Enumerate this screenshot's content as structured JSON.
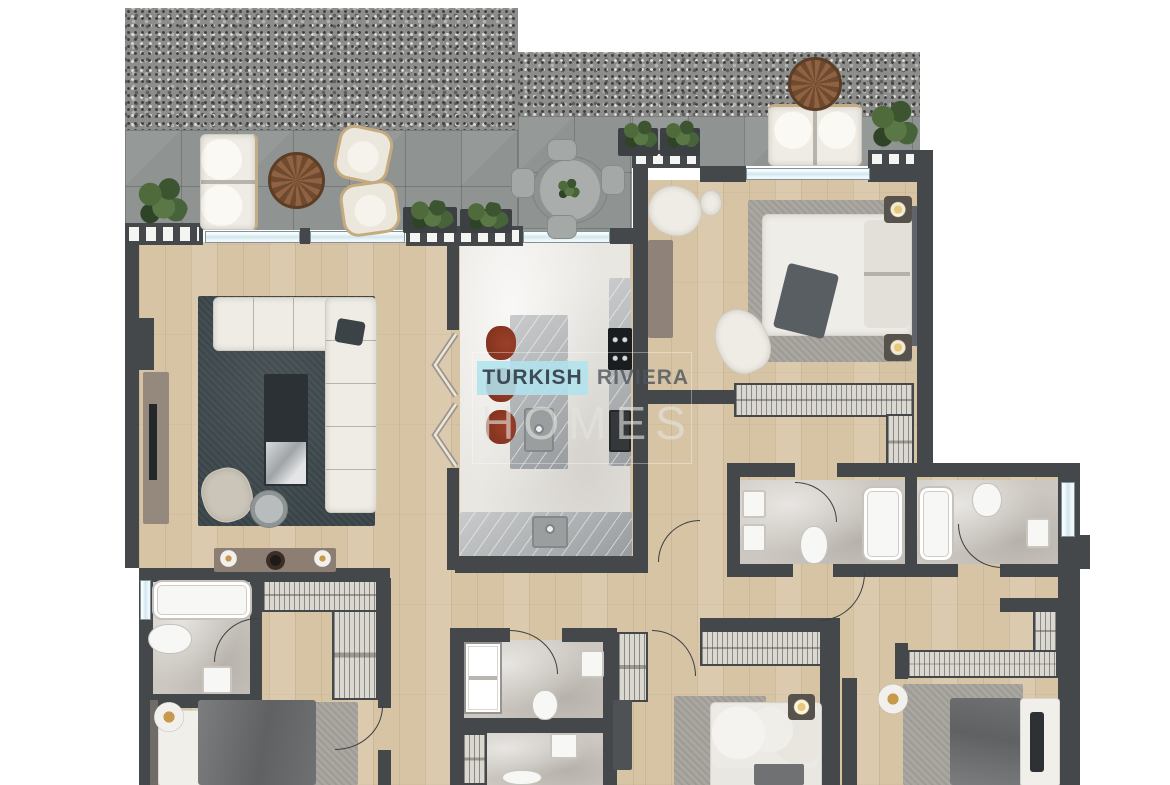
{
  "watermark": {
    "primary": "TURKISH",
    "secondary": "RIVIERA",
    "tertiary": "HOMES"
  },
  "palette": {
    "wall": "#44484b",
    "wood": "#d7c4a5",
    "tile": "#8f9392",
    "kitchen_floor": "#e9e7e2",
    "bath_floor": "#ccc7c0",
    "counter": "#b1b4b6",
    "rug_dark": "#404b4f",
    "rug_light": "#aaa7a1",
    "upholstery": "#efece5",
    "stool_red": "#7c2f1c",
    "plant_green": "#4a653b",
    "table_wood": "#8e6243",
    "hatch": "#dbd8d2",
    "window_glass": "#cfe7ef",
    "lamp_glow": "#c79a4b",
    "blanket_gray": "#6e7072",
    "watermark_teal": "#b0e2ee",
    "watermark_text": "#3e4a55"
  },
  "plan": {
    "type": "apartment-floor-plan",
    "areas": [
      "terrace",
      "living-room",
      "kitchen",
      "bedroom-1",
      "bedroom-2",
      "bedroom-3",
      "bedroom-4",
      "bathroom-1",
      "bathroom-2",
      "bathroom-3",
      "bathroom-4",
      "hallway",
      "walk-in-wardrobe"
    ],
    "furniture_icons": [
      "sofa",
      "armchair",
      "coffee-table",
      "side-table",
      "tv-unit",
      "console-table",
      "kitchen-island",
      "bar-stool",
      "cooktop",
      "oven",
      "sink",
      "dining-table",
      "outdoor-sofa",
      "outdoor-lounge-chair",
      "planter",
      "plant",
      "round-coffee-table",
      "double-bed",
      "nightstand",
      "wall-lamp",
      "rug",
      "wardrobe",
      "bathtub",
      "shower",
      "toilet",
      "washbasin",
      "door-swing",
      "window",
      "railing",
      "folding-door"
    ]
  }
}
